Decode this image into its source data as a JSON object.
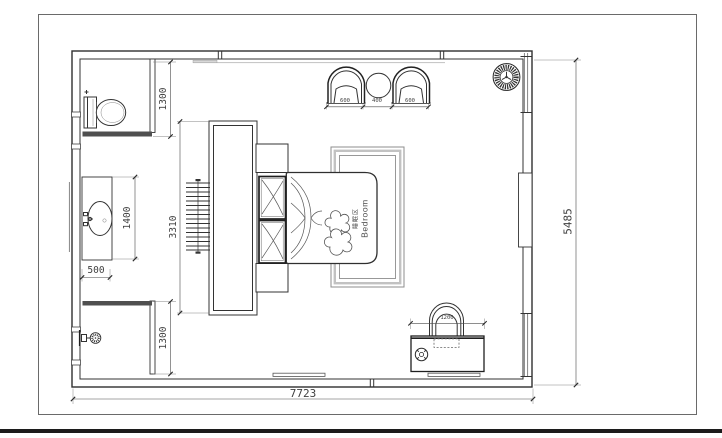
{
  "plan": {
    "bed_label": {
      "cn": "睡眠区",
      "en": "Bedroom"
    },
    "dims": {
      "overall_width": "7723",
      "overall_depth": "5485",
      "headboard_wall": "3310",
      "wc_depth": "1300",
      "shower_depth": "1300",
      "vanity_counter_length": "1400",
      "vanity_counter_width": "500",
      "armchair_left": "600",
      "side_table": "400",
      "armchair_right": "600",
      "desk_width": "1200"
    },
    "colors": {
      "line": "#333333",
      "wall_accent": "#4f4f4f",
      "dim_text": "#3f3f3f",
      "rug_band": "#c2c2c2"
    }
  }
}
